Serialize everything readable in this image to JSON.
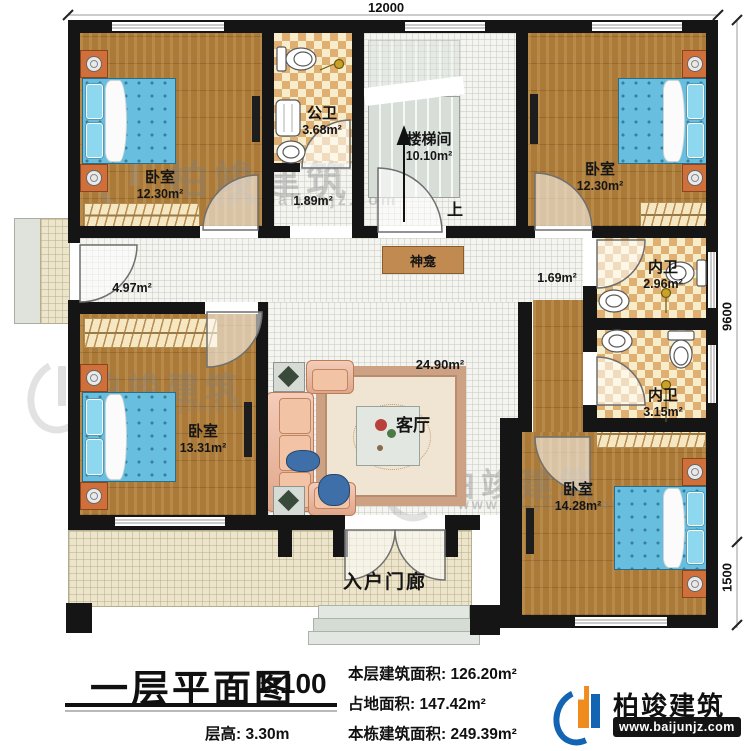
{
  "dimensions": {
    "top": "12000",
    "right_upper": "9600",
    "right_lower": "1500"
  },
  "rooms": {
    "bedroom_tl": {
      "name": "卧室",
      "area": "12.30m²"
    },
    "public_bath": {
      "name": "公卫",
      "area": "3.68m²"
    },
    "vestibule": {
      "area": "1.89m²"
    },
    "stairwell": {
      "name": "楼梯间",
      "area": "10.10m²",
      "up": "上"
    },
    "bedroom_tr": {
      "name": "卧室",
      "area": "12.30m²"
    },
    "hallway": {
      "area": "4.97m²"
    },
    "shrine": {
      "name": "神龛"
    },
    "passage": {
      "area": "1.69m²"
    },
    "ensuite_top": {
      "name": "内卫",
      "area": "2.96m²"
    },
    "ensuite_bottom": {
      "name": "内卫",
      "area": "3.15m²"
    },
    "living": {
      "name": "客厅",
      "area": "24.90m²"
    },
    "bedroom_bl": {
      "name": "卧室",
      "area": "13.31m²"
    },
    "bedroom_br": {
      "name": "卧室",
      "area": "14.28m²"
    },
    "porch": {
      "name": "入户门廊"
    }
  },
  "title_block": {
    "title": "一层平面图",
    "scale": "1:100",
    "floor_height": "层高: 3.30m",
    "stats": [
      {
        "label": "本层建筑面积:",
        "value": "126.20m²"
      },
      {
        "label": "占地面积:",
        "value": "147.42m²"
      },
      {
        "label": "本栋建筑面积:",
        "value": "249.39m²"
      }
    ]
  },
  "branding": {
    "brand": "柏竣建筑",
    "url": "www.baijunjz.com"
  },
  "watermark": {
    "brand": "柏竣建筑",
    "url": "www.baijunjz.com"
  }
}
